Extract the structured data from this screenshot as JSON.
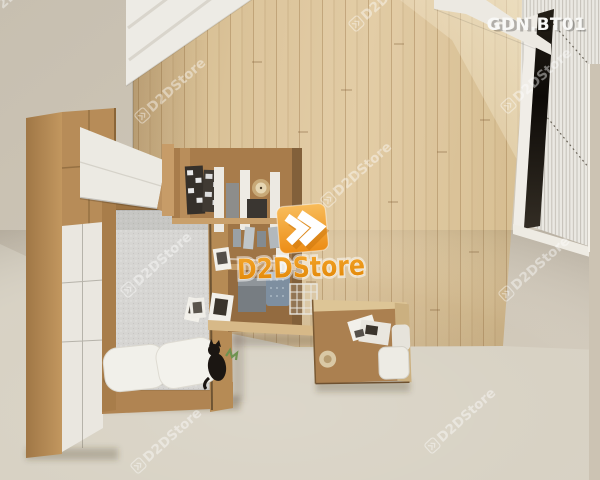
{
  "header": {
    "code": "GDN.BT01"
  },
  "logo": {
    "text": "D2DStore",
    "icon": "double-chevron-right-icon",
    "orange": "#f09a2c",
    "orange_deep": "#e08404"
  },
  "watermark": {
    "text": "D2DStore",
    "icon": "double-chevron-right-icon",
    "opacity": "0.42"
  },
  "scene": {
    "type": "3d-interior-render-top-down",
    "room": "bedroom-furniture-set",
    "colors": {
      "wall": "#ccc4b5",
      "floor": "#d8d2c4",
      "wood_accent_wall": "#dcc59c",
      "furniture_wood": "#b78c58",
      "furniture_white": "#eceae3",
      "mattress_gray": "#d6d5d2",
      "blind_white": "#eae8e2",
      "window_gap_dark": "#15110c",
      "cat_black": "#1b1612",
      "plant_green": "#6f9350"
    },
    "objects": [
      "wardrobe",
      "loft-cabinet",
      "bed",
      "mattress",
      "pillows",
      "black-cat",
      "plant",
      "wall-shelf-unit",
      "photo-cards",
      "storage-boxes",
      "wire-basket",
      "clock",
      "desk",
      "desk-chair",
      "papers",
      "wood-accent-wall",
      "ceiling-beams",
      "window-blinds",
      "window-gap"
    ]
  }
}
